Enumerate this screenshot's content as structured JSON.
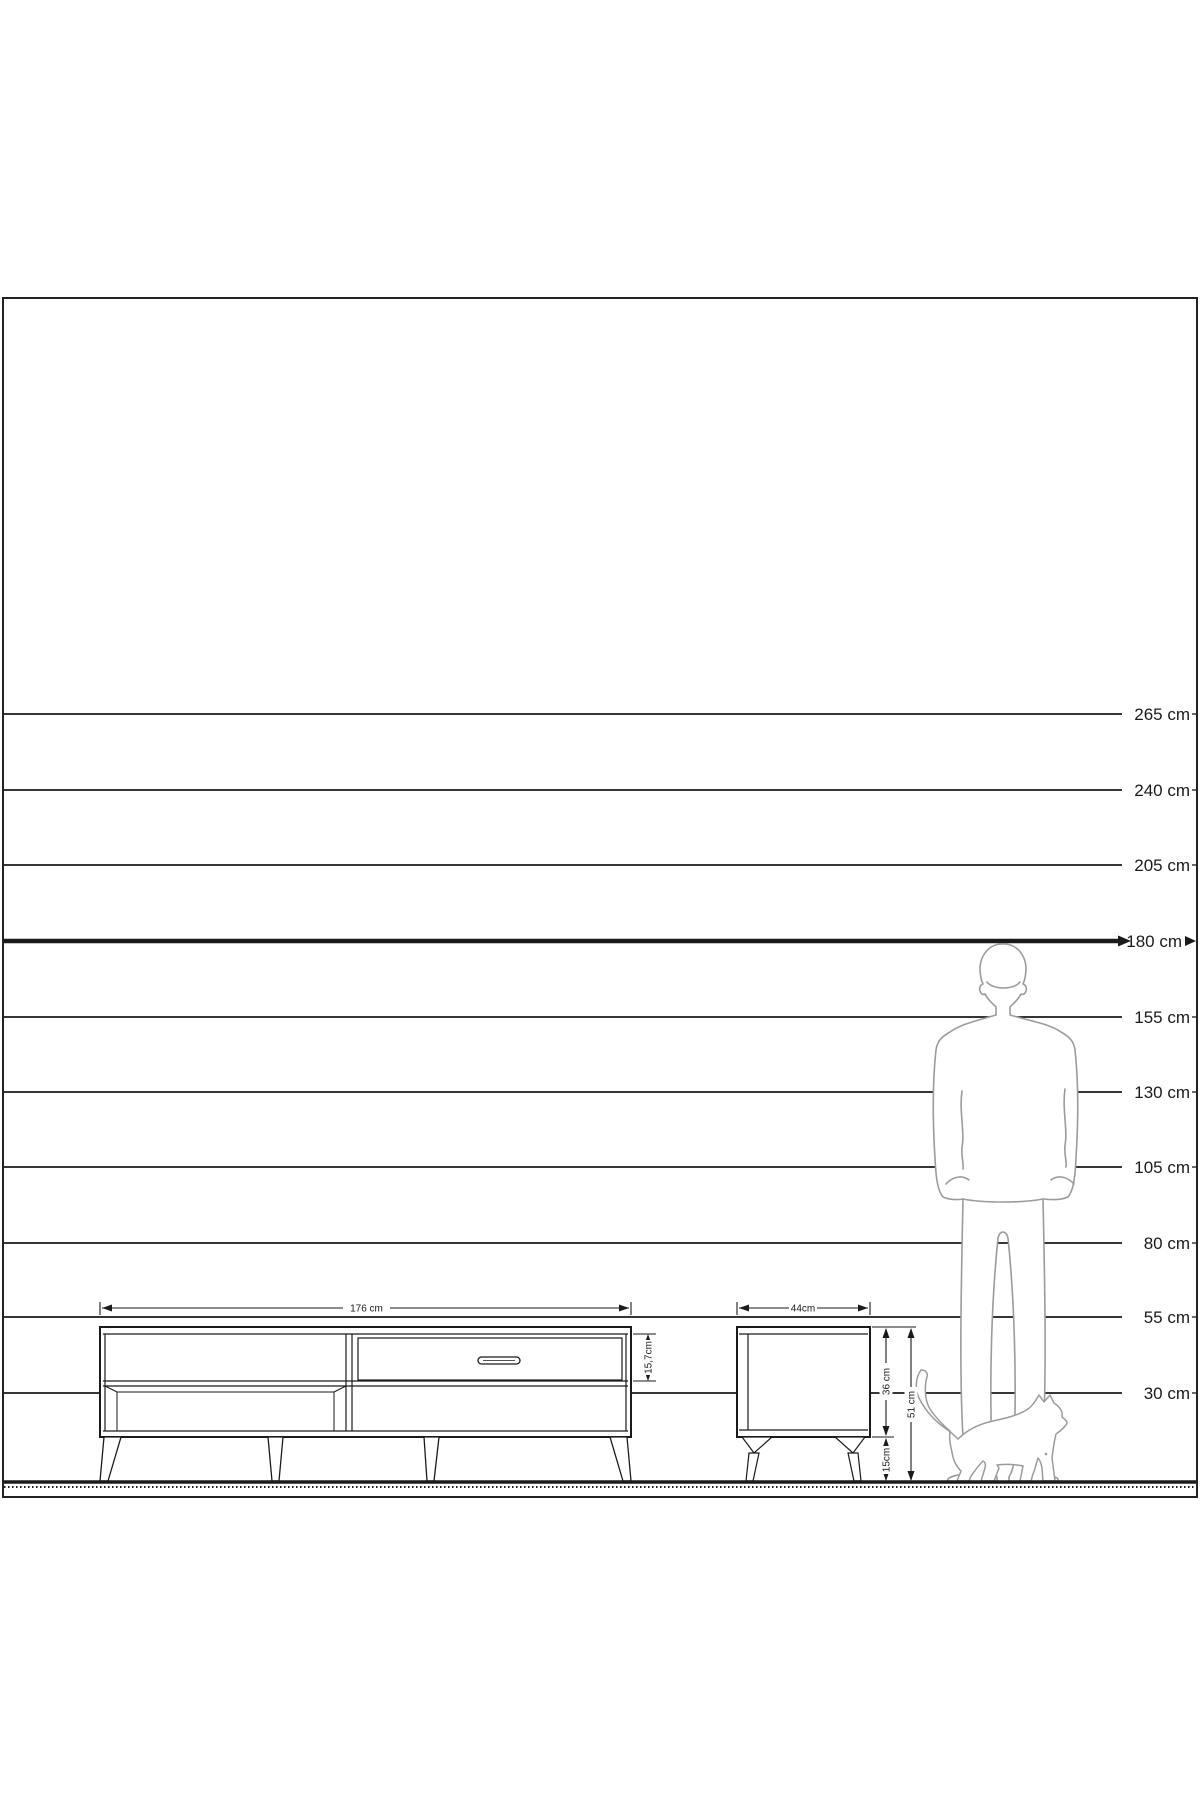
{
  "diagram": {
    "title": "furniture height scale diagram",
    "background_color": "#ffffff",
    "line_color": "#1a1a1a",
    "silhouette_color": "#9b9b9b",
    "unit": "cm"
  },
  "scale": {
    "lines": [
      {
        "cm": 265,
        "label": "265 cm",
        "emphasis": false
      },
      {
        "cm": 240,
        "label": "240 cm",
        "emphasis": false
      },
      {
        "cm": 205,
        "label": "205 cm",
        "emphasis": false
      },
      {
        "cm": 180,
        "label": "180 cm",
        "emphasis": true
      },
      {
        "cm": 155,
        "label": "155 cm",
        "emphasis": false
      },
      {
        "cm": 130,
        "label": "130 cm",
        "emphasis": false
      },
      {
        "cm": 105,
        "label": "105 cm",
        "emphasis": false
      },
      {
        "cm": 80,
        "label": "80 cm",
        "emphasis": false
      },
      {
        "cm": 55,
        "label": "55 cm",
        "emphasis": false
      },
      {
        "cm": 30,
        "label": "30 cm",
        "emphasis": false
      }
    ]
  },
  "furniture": {
    "tv_stand": {
      "name": "TV stand",
      "width_label": "176 cm",
      "top_drawer_height_label": "15,7cm"
    },
    "nightstand": {
      "name": "nightstand",
      "width_label": "44cm",
      "body_height_label": "36 cm",
      "leg_height_label": "15cm",
      "total_height_label": "51 cm"
    }
  },
  "figures": {
    "man": {
      "description": "standing man silhouette, back view, head at 180 cm line"
    },
    "cat": {
      "description": "walking cat silhouette at the man's feet"
    }
  }
}
